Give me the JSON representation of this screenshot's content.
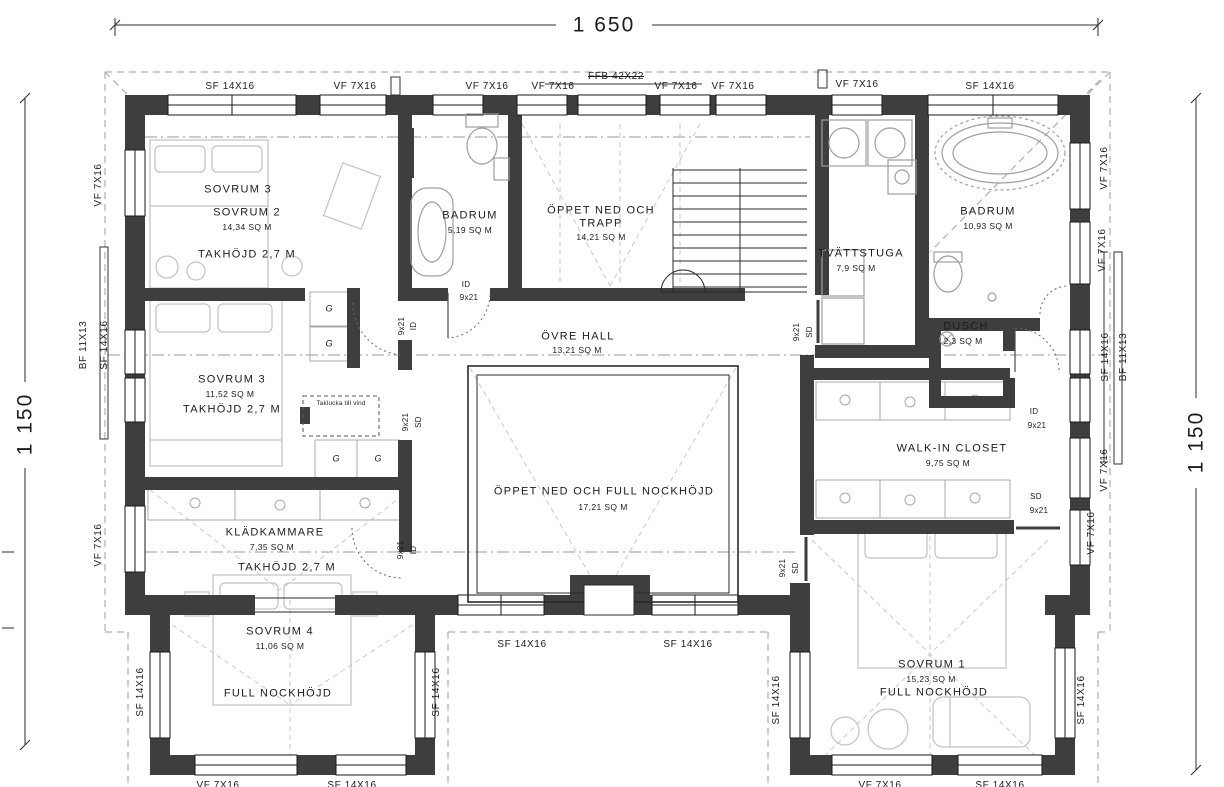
{
  "drawing": {
    "dim_top": "1 650",
    "dim_left": "1 150",
    "dim_right": "1 150"
  },
  "labels": {
    "vf": "VF 7X16",
    "sf": "SF 14X16",
    "bf": "BF 11X13",
    "ffb": "FFB 42X22",
    "id": "ID",
    "sd": "SD",
    "door_size": "9x21",
    "g": "G",
    "taklucka": "Taklucka till vind"
  },
  "rooms": {
    "sovrum2": {
      "alt": "SOVRUM 3",
      "name": "SOVRUM 2",
      "area": "14,34 SQ M",
      "ceiling": "TAKHÖJD 2,7 M"
    },
    "badrum_left": {
      "name": "BADRUM",
      "area": "5,19 SQ M"
    },
    "trapp": {
      "line1": "ÖPPET NED OCH",
      "line2": "TRAPP",
      "area": "14,21 SQ M"
    },
    "tvattstuga": {
      "name": "TVÄTTSTUGA",
      "area": "7,9 SQ M"
    },
    "badrum_right": {
      "name": "BADRUM",
      "area": "10,93 SQ M"
    },
    "dusch": {
      "name": "DUSCH",
      "area": "2,3 SQ M"
    },
    "ovre_hall": {
      "name": "ÖVRE HALL",
      "area": "13,21 SQ M"
    },
    "oppet_ned": {
      "name": "ÖPPET NED OCH FULL NOCKHÖJD",
      "area": "17,21 SQ M"
    },
    "sovrum3": {
      "name": "SOVRUM 3",
      "area": "11,52 SQ M",
      "ceiling": "TAKHÖJD 2,7 M"
    },
    "kladkammare": {
      "name": "KLÄDKAMMARE",
      "area": "7,35 SQ M",
      "ceiling": "TAKHÖJD 2,7 M"
    },
    "walkin": {
      "name": "WALK-IN CLOSET",
      "area": "9,75 SQ M"
    },
    "sovrum4": {
      "name": "SOVRUM 4",
      "area": "11,06 SQ M",
      "height": "FULL NOCKHÖJD"
    },
    "sovrum1": {
      "name": "SOVRUM 1",
      "area": "15,23 SQ M",
      "height": "FULL NOCKHÖJD"
    }
  }
}
